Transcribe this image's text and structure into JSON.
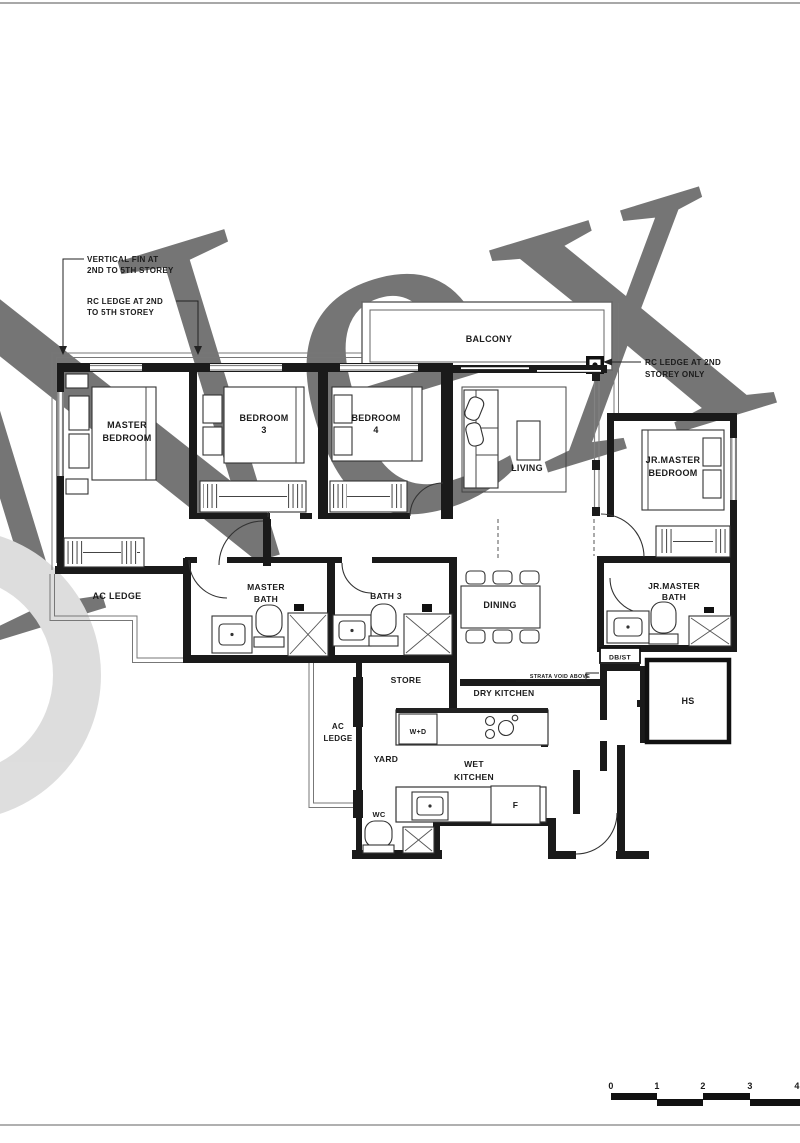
{
  "watermark": {
    "text": "Nex"
  },
  "annotations": {
    "vertical_fin": {
      "line1": "VERTICAL FIN AT",
      "line2": "2ND TO 5TH STOREY"
    },
    "rc_ledge_left": {
      "line1": "RC LEDGE AT 2ND",
      "line2": "TO 5TH STOREY"
    },
    "rc_ledge_right": {
      "line1": "RC LEDGE AT 2ND",
      "line2": "STOREY ONLY"
    },
    "strata_void": "STRATA VOID ABOVE"
  },
  "rooms": {
    "balcony": "BALCONY",
    "living": "LIVING",
    "dining": "DINING",
    "master_bedroom": {
      "line1": "MASTER",
      "line2": "BEDROOM"
    },
    "bedroom3": {
      "line1": "BEDROOM",
      "line2": "3"
    },
    "bedroom4": {
      "line1": "BEDROOM",
      "line2": "4"
    },
    "jr_master_bedroom": {
      "line1": "JR.MASTER",
      "line2": "BEDROOM"
    },
    "master_bath": {
      "line1": "MASTER",
      "line2": "BATH"
    },
    "bath3": "BATH 3",
    "jr_master_bath": {
      "line1": "JR.MASTER",
      "line2": "BATH"
    },
    "ac_ledge": "AC LEDGE",
    "ac_ledge_mid": {
      "line1": "AC",
      "line2": "LEDGE"
    },
    "store": "STORE",
    "dry_kitchen": "DRY KITCHEN",
    "wet_kitchen": {
      "line1": "WET",
      "line2": "KITCHEN"
    },
    "yard": "YARD",
    "wc": "WC",
    "db_st": "DB/ST",
    "hs": "HS",
    "wd": "W+D",
    "fridge": "F"
  },
  "scale_bar": {
    "t0": "0",
    "t1": "1",
    "t2": "2",
    "t3": "3",
    "t4": "4"
  }
}
